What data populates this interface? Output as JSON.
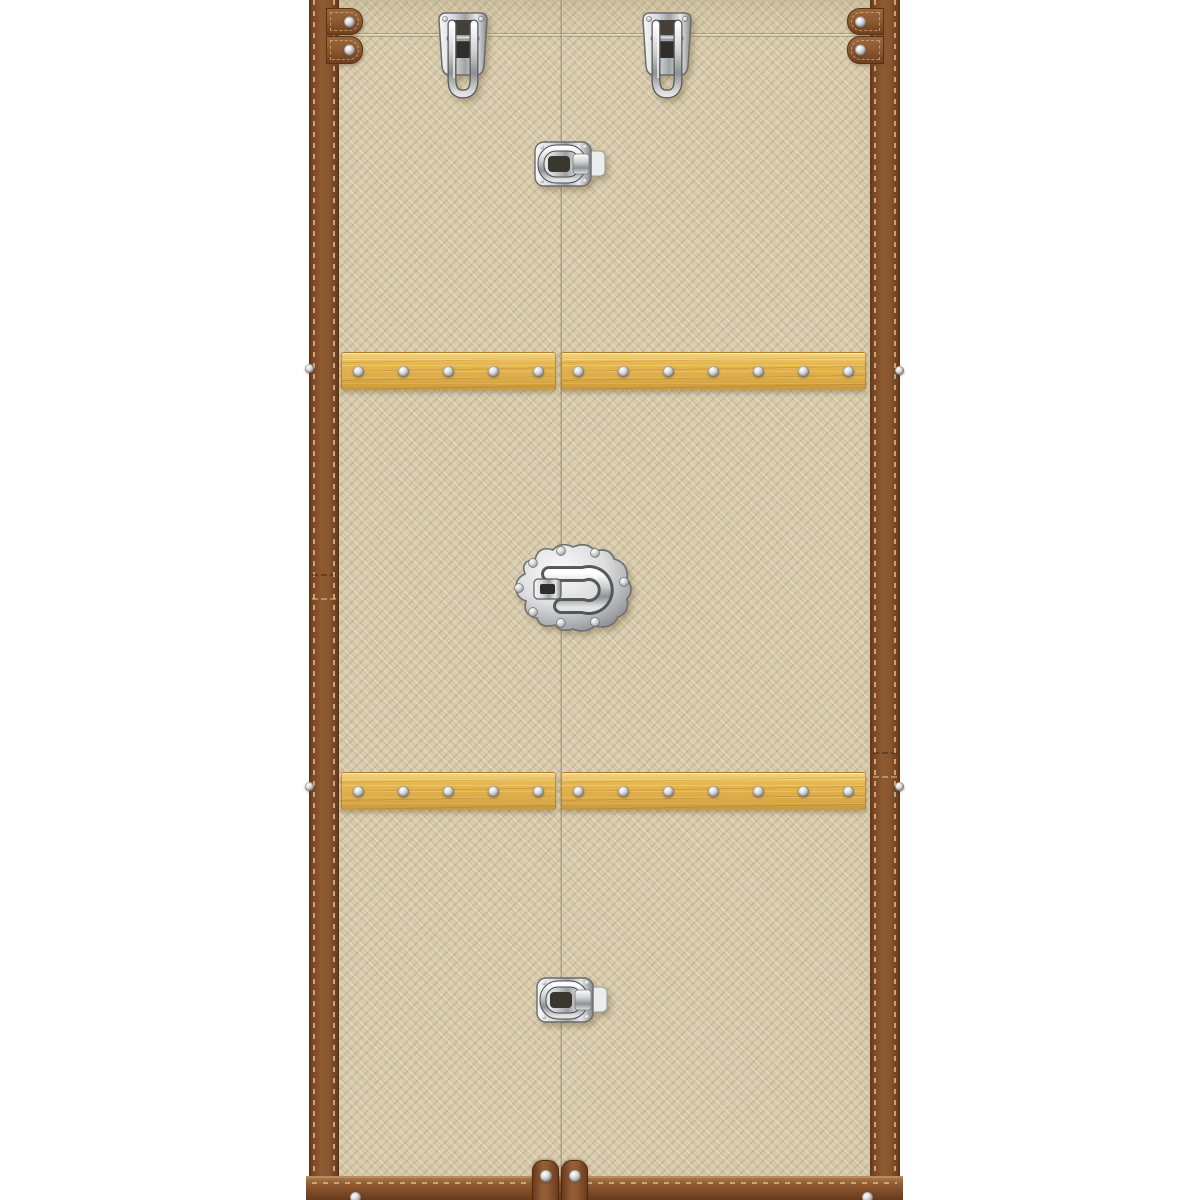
{
  "scene": {
    "description": "Product photo of a tall wardrobe trunk cabinet with beige woven canvas doors, brown stitched leather edge trim, riveted oak wood slats and polished chrome trunk latches, standing on a white background",
    "object": "trunk-wardrobe-cabinet"
  },
  "colors": {
    "background": "#ffffff",
    "canvas_base": "#d9cdad",
    "canvas_weave_dark": "#c7b995",
    "canvas_weave_light": "#e9dfc4",
    "leather": "#8f5a31",
    "leather_dark": "#5f3517",
    "stitch": "#e3c293",
    "wood": "#e7b750",
    "wood_grain": "#cf9a33",
    "chrome_light": "#f7f8f8",
    "chrome_mid": "#b9babd",
    "chrome_dark": "#5d5e62",
    "seam": "#766642"
  },
  "hardware": {
    "top_drawbolt_latches": {
      "count": 2,
      "type": "chrome drawbolt latch"
    },
    "upper_center_latch": {
      "count": 1,
      "type": "chrome case latch"
    },
    "center_lock": {
      "count": 1,
      "type": "ornate chrome trunk lock with swing hasp"
    },
    "bottom_latch": {
      "count": 1,
      "type": "chrome case latch"
    },
    "slat_rows": [
      {
        "material": "oak",
        "left_rivets": 5,
        "right_rivets": 7
      },
      {
        "material": "oak",
        "left_rivets": 5,
        "right_rivets": 7
      }
    ],
    "corner_strap_tabs": {
      "count": 4,
      "rivets_each": 1
    },
    "bottom_strap_tabs": {
      "count": 2,
      "rivets_each": 1
    },
    "base_band_rivets": 2,
    "side_edge_rivets": 4
  }
}
